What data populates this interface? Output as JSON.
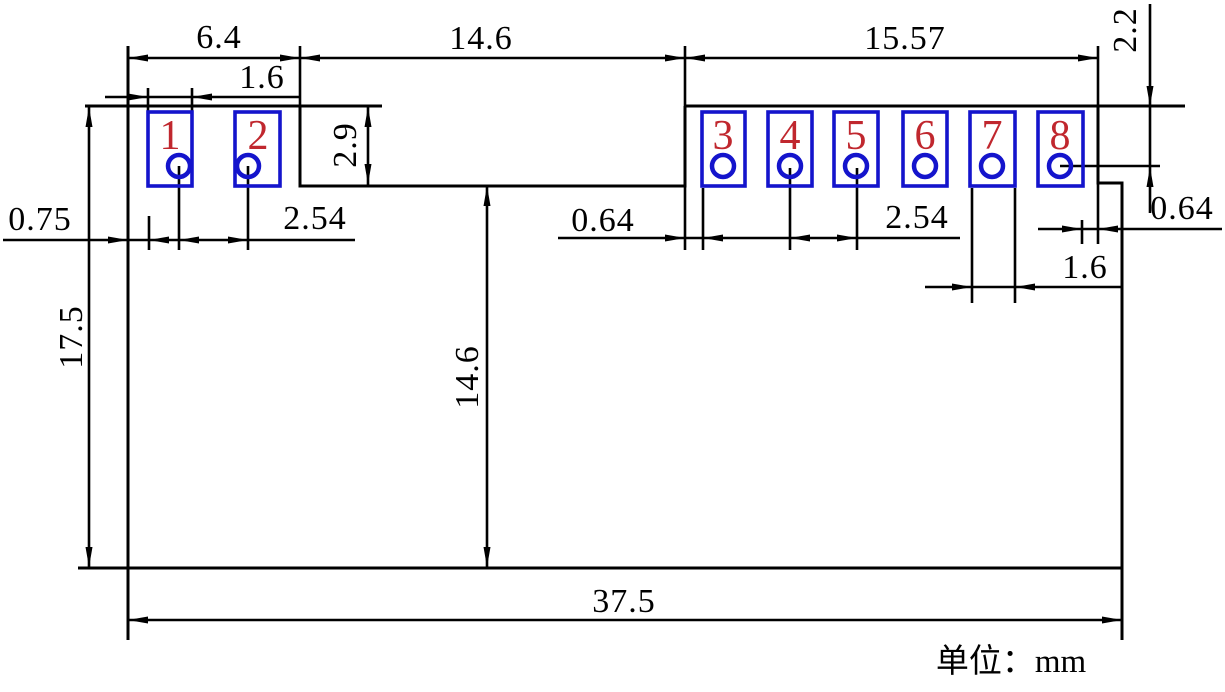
{
  "drawing": {
    "type": "mechanical-dimension-drawing",
    "unit_note": "单位：mm"
  },
  "colors": {
    "line": "#000000",
    "pad": "#1414cc",
    "pad_number": "#c0272e"
  },
  "pads": {
    "numbers": [
      "1",
      "2",
      "3",
      "4",
      "5",
      "6",
      "7",
      "8"
    ]
  },
  "dims": {
    "left_section_width": "6.4",
    "left_pad_width": "1.6",
    "notch_width": "14.6",
    "right_section_width": "15.57",
    "hole_top_offset": "2.2",
    "pad_height": "2.9",
    "left_margin": "0.75",
    "left_pitch": "2.54",
    "notch_pad_gap": "0.64",
    "right_pitch": "2.54",
    "pad_edge_gap": "0.64",
    "right_pad_width": "1.6",
    "board_height": "17.5",
    "notch_depth": "14.6",
    "board_width": "37.5"
  }
}
